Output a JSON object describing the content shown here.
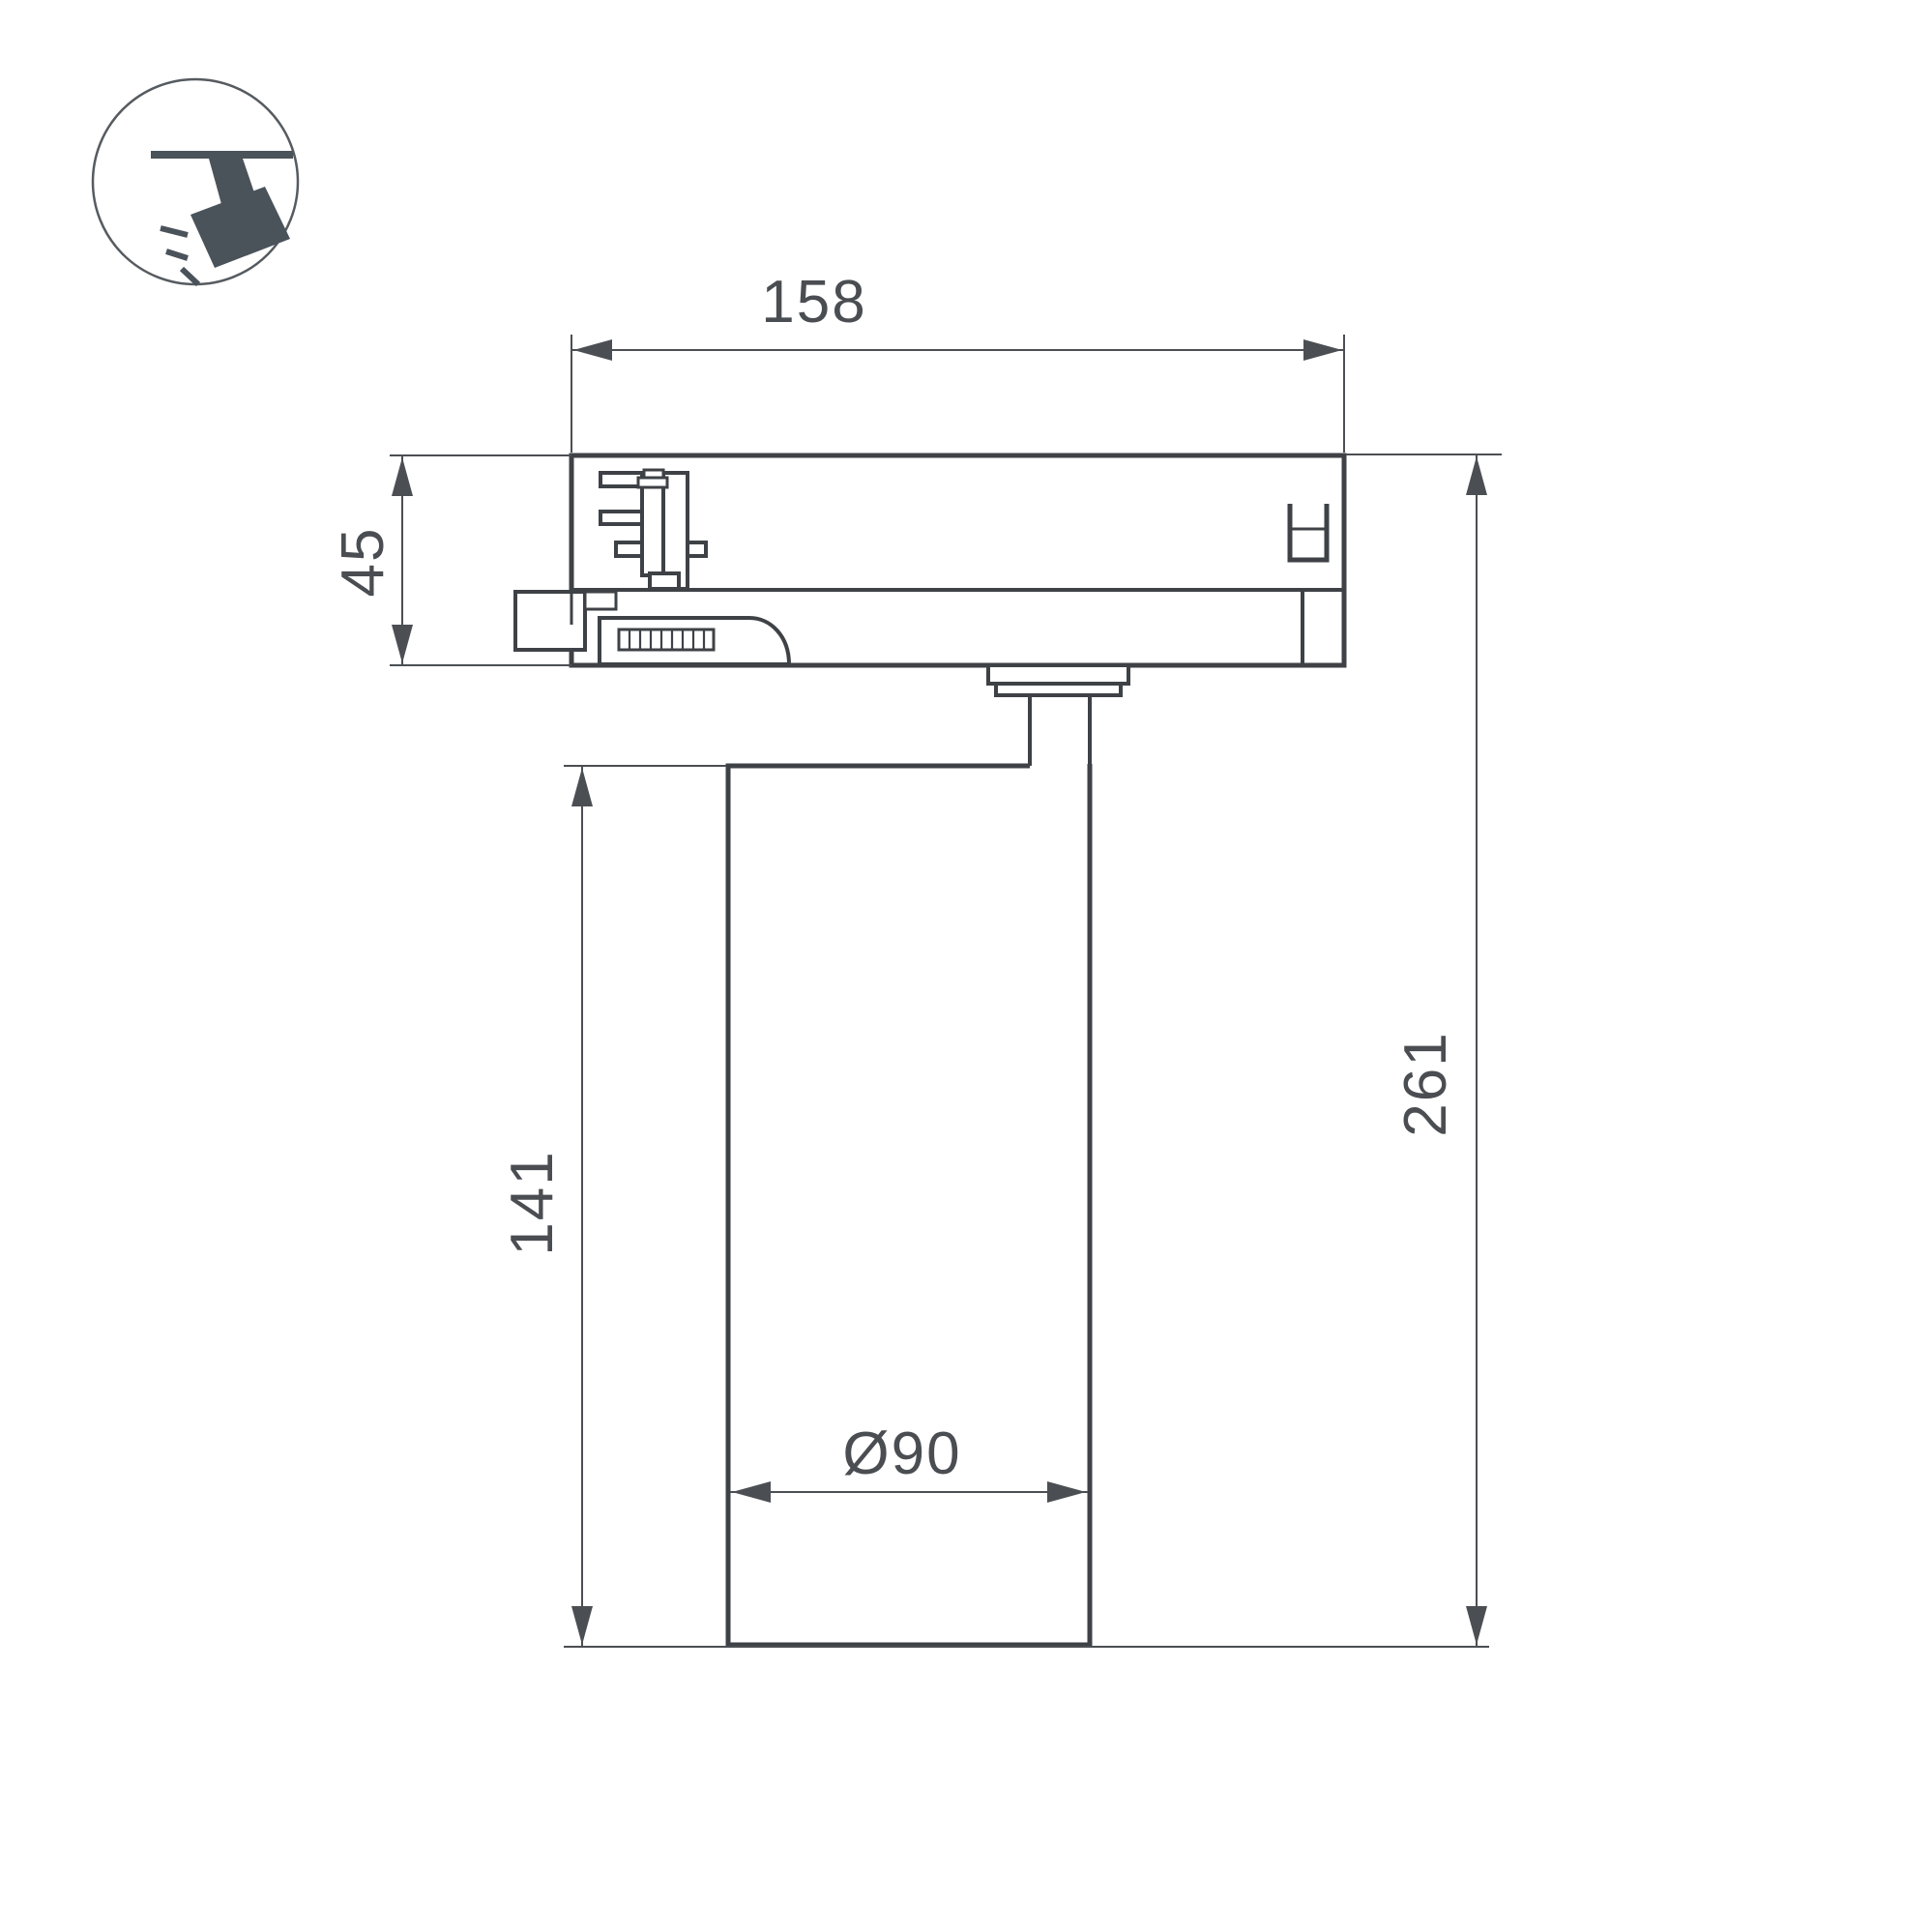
{
  "dimensions": {
    "adapter_width": "158",
    "adapter_height": "45",
    "body_height": "141",
    "total_height": "261",
    "body_diameter": "Ø90"
  },
  "icon": {
    "name": "track-spotlight-icon"
  },
  "colors": {
    "outline": "#3e4246",
    "dimension_line": "#4b4f53",
    "dimension_text": "#4a4d51",
    "icon_fill": "#4a525a",
    "icon_stroke": "#565b60",
    "background": "#ffffff"
  }
}
